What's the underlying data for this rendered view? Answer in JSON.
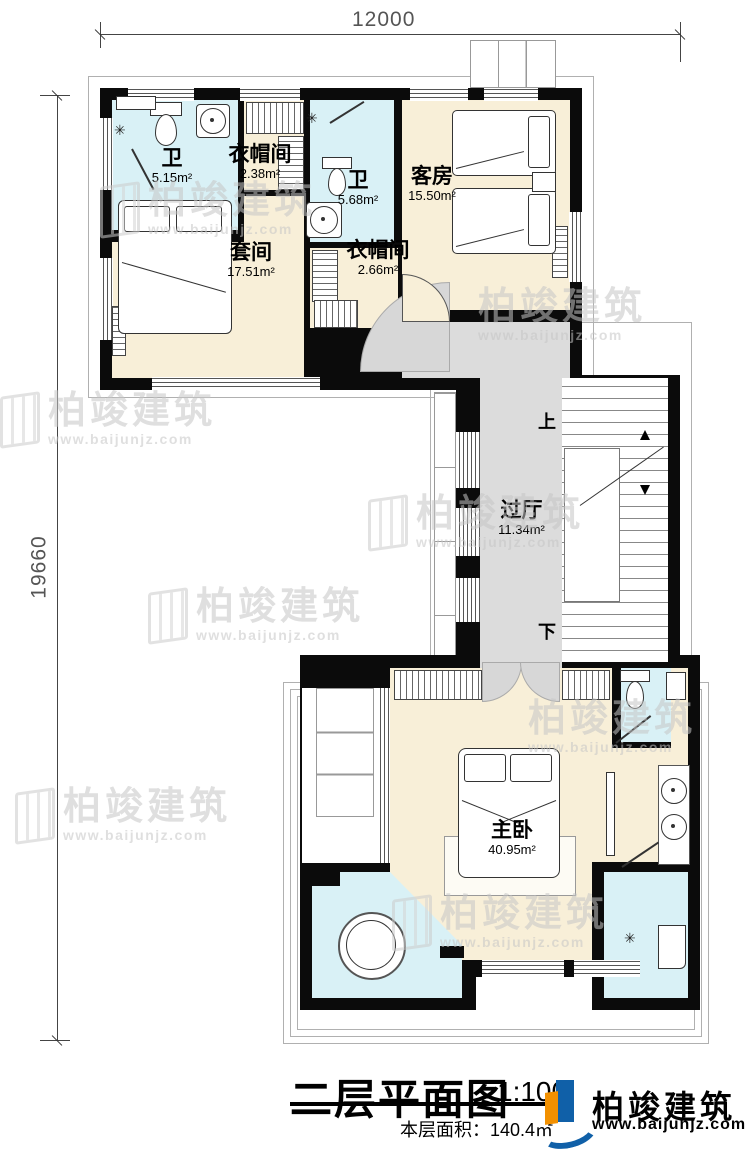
{
  "dimensions": {
    "width_label": "12000",
    "height_label": "19660"
  },
  "rooms": {
    "bath1": {
      "label": "卫",
      "area": "5.15m²"
    },
    "cloak1": {
      "label": "衣帽间",
      "area": "2.38m²"
    },
    "bath2": {
      "label": "卫",
      "area": "5.68m²"
    },
    "guest": {
      "label": "客房",
      "area": "15.50m²"
    },
    "suite": {
      "label": "套间",
      "area": "17.51m²"
    },
    "cloak2": {
      "label": "衣帽间",
      "area": "2.66m²"
    },
    "hall": {
      "label": "过厅",
      "area": "11.34m²"
    },
    "master": {
      "label": "主卧",
      "area": "40.95m²"
    }
  },
  "stairs": {
    "up": "上",
    "down": "下"
  },
  "icons": {
    "sprinkler": "✳",
    "target": "⊕"
  },
  "title": {
    "text": "二层平面图",
    "scale": "1:100",
    "floor_area": "本层面积：140.4㎡"
  },
  "logo": {
    "name": "柏竣建筑",
    "url": "www.baijunjz.com"
  },
  "watermark": {
    "text": "柏竣建筑",
    "url": "www.baijunjz.com"
  },
  "colors": {
    "wall": "#0b0b0b",
    "bedroom": "#f8efd8",
    "bathroom": "#d9f1f6",
    "hall": "#dcdcdc",
    "logo_blue": "#1060a8",
    "logo_orange": "#f29000"
  }
}
